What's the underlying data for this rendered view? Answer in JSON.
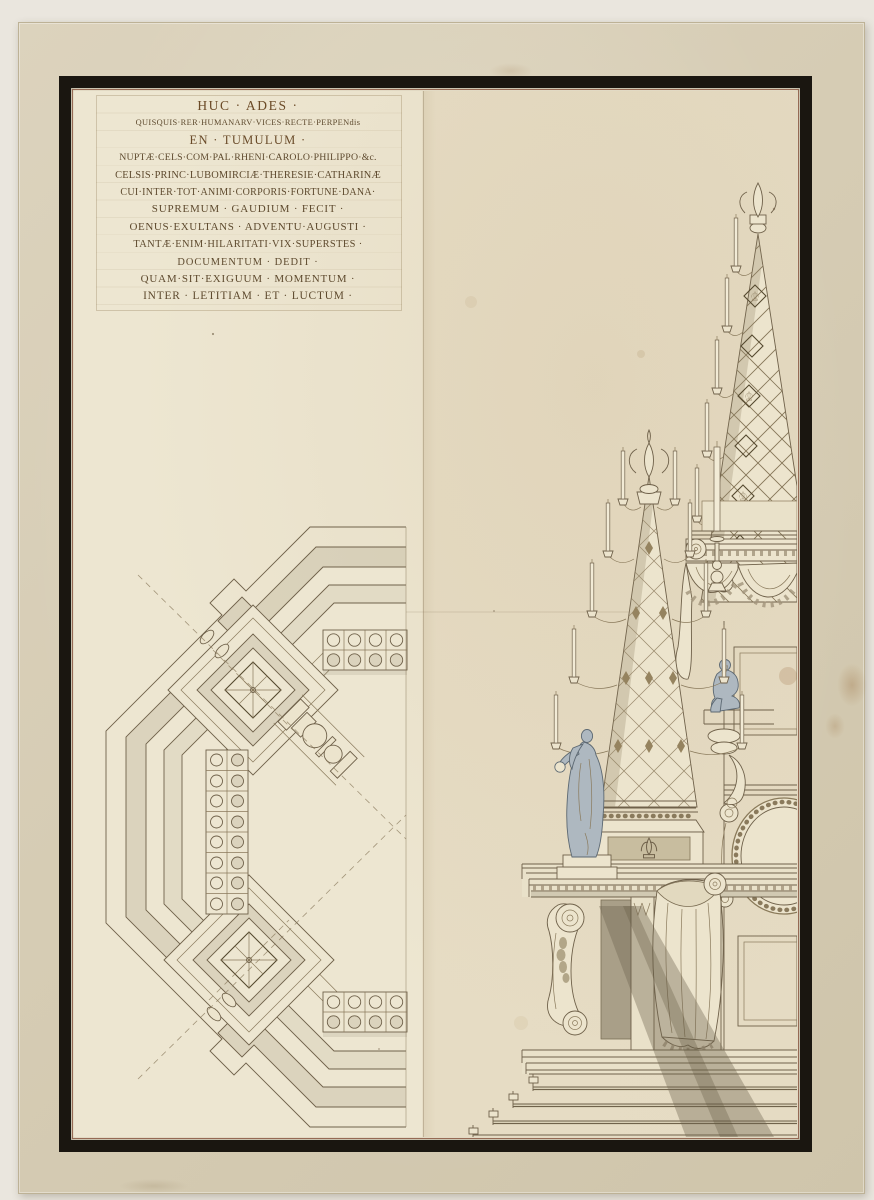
{
  "artwork": {
    "inscription": {
      "lines": [
        "HUC · ADES ·",
        "QUISQUIS·RER·HUMANARV·VICES·RECTE·PERPENdis",
        "EN · TUMULUM ·",
        "NUPTÆ·CELS·COM·PAL·RHENI·CAROLO·PHILIPPO·&c.",
        "CELSIS·PRINC·LUBOMIRCIÆ·THERESIE·CATHARINÆ",
        "CUI·INTER·TOT·ANIMI·CORPORIS·FORTUNE·DANA·",
        "SUPREMUM · GAUDIUM · FECIT ·",
        "OENUS·EXULTANS · ADVENTU·AUGUSTI ·",
        "TANTÆ·ENIM·HILARITATI·VIX·SUPERSTES ·",
        "DOCUMENTUM · DEDIT ·",
        "QUAM·SIT·EXIGUUM · MOMENTUM ·",
        "INTER · LETITIAM · ET · LUCTUM ·"
      ]
    },
    "palette": {
      "backdrop": "#eae6de",
      "mount": "#d6ccb4",
      "frame": "#1a1610",
      "inner_rule": "#84503a",
      "paper_left": "#ede6d1",
      "paper_right": "#e5dbc3",
      "ink": "#5e4a2e",
      "wash_gray": "#9c9176",
      "figure_wash_blue": "#aeb8c0"
    }
  }
}
